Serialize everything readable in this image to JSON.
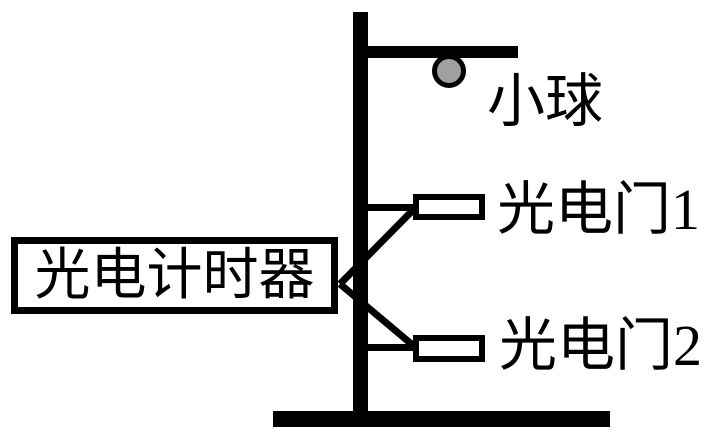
{
  "diagram": {
    "description": "photogate free-fall timing experiment apparatus",
    "labels": {
      "ball": "小球",
      "gate1": "光电门1",
      "gate2": "光电门2",
      "timer": "光电计时器"
    },
    "colors": {
      "stroke": "#000000",
      "ball_fill": "#a0a0a0",
      "background": "#ffffff"
    }
  }
}
